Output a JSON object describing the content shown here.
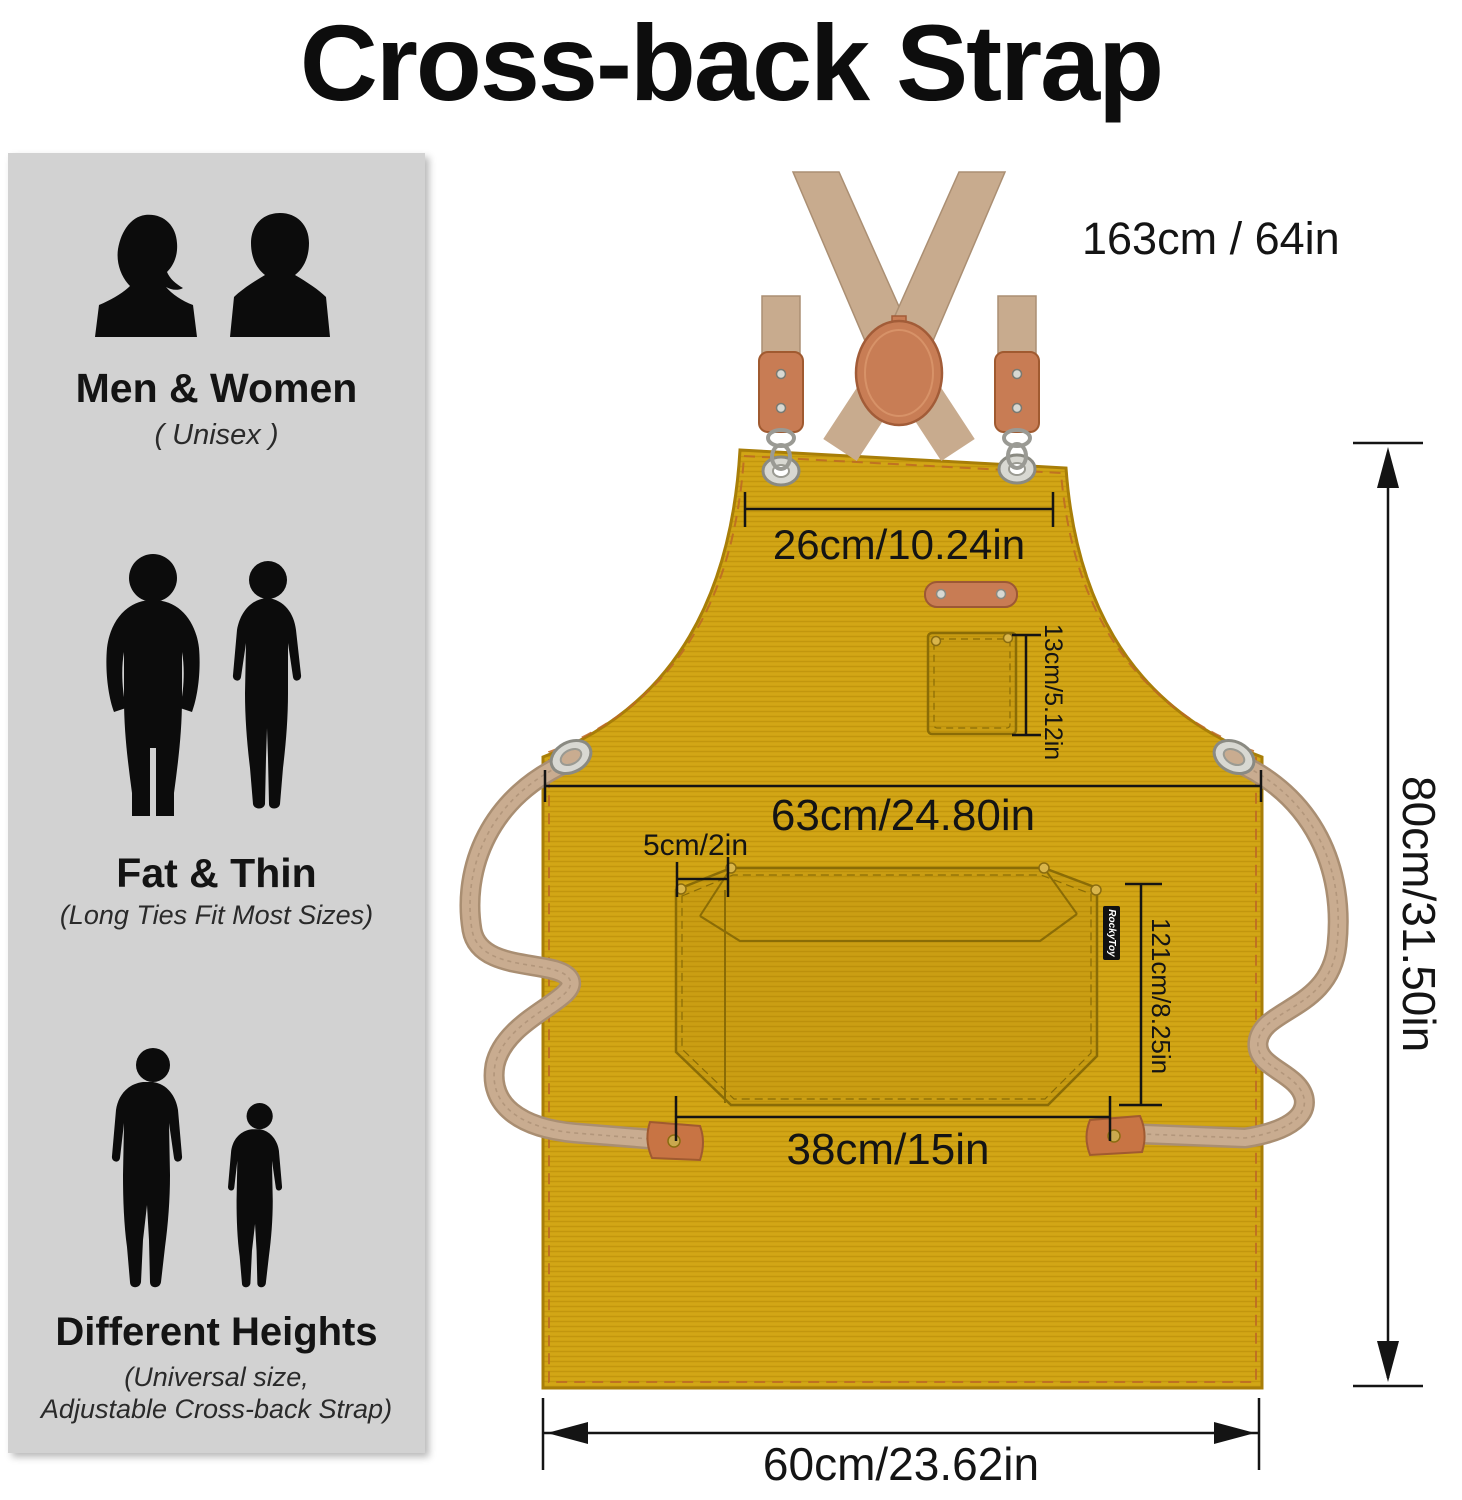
{
  "title": "Cross-back Strap",
  "sidebar": {
    "sections": [
      {
        "heading": "Men & Women",
        "subtext": "( Unisex )"
      },
      {
        "heading": "Fat & Thin",
        "subtext": "(Long Ties Fit Most Sizes)"
      },
      {
        "heading": "Different Heights",
        "subtext_lines": [
          "(Universal size,",
          "Adjustable Cross-back Strap)"
        ]
      }
    ]
  },
  "measurements": {
    "strap_length": "163cm / 64in",
    "neck_width": "26cm/10.24in",
    "chest_pocket_height": "13cm/5.12in",
    "waist_width": "63cm/24.80in",
    "tool_slot_width": "5cm/2in",
    "front_pocket_height": "121cm/8.25in",
    "front_pocket_width": "38cm/15in",
    "apron_length": "80cm/31.50in",
    "apron_bottom_width": "60cm/23.62in"
  },
  "brand_tag": "RockyToy",
  "colors": {
    "apron": "#cfa213",
    "strap_webbing": "#c8ab8e",
    "leather": "#c87c54",
    "sidebar_bg": "#d2d2d2",
    "dimension_lines": "#141414"
  }
}
